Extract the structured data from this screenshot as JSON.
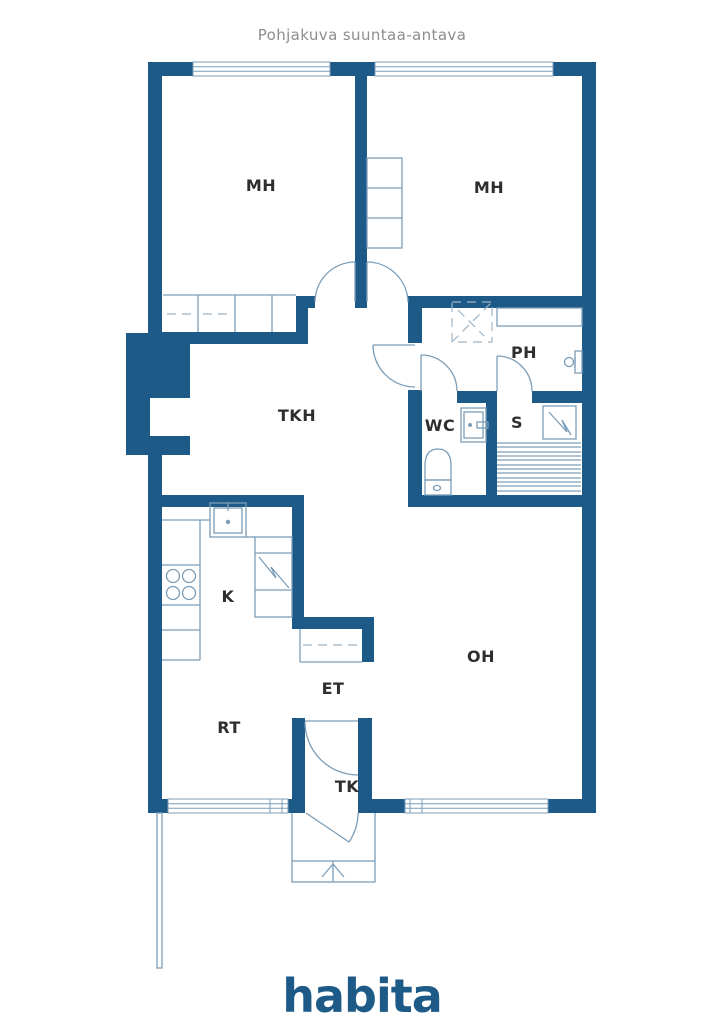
{
  "title": "Pohjakuva suuntaa-antava",
  "logo": "habita",
  "colors": {
    "wall": "#1e5a88",
    "fixture_line": "#7c9db7",
    "label_text": "#2e2e2e",
    "title_text": "#8d8d8d",
    "logo_blue": "#1d5a87"
  },
  "rooms": {
    "mh_left": {
      "label": "MH"
    },
    "mh_right": {
      "label": "MH"
    },
    "ph": {
      "label": "PH"
    },
    "wc": {
      "label": "WC"
    },
    "sauna": {
      "label": "S"
    },
    "tkh": {
      "label": "TKH"
    },
    "kitchen": {
      "label": "K"
    },
    "et": {
      "label": "ET"
    },
    "oh": {
      "label": "OH"
    },
    "rt": {
      "label": "RT"
    },
    "tk": {
      "label": "TK"
    }
  }
}
